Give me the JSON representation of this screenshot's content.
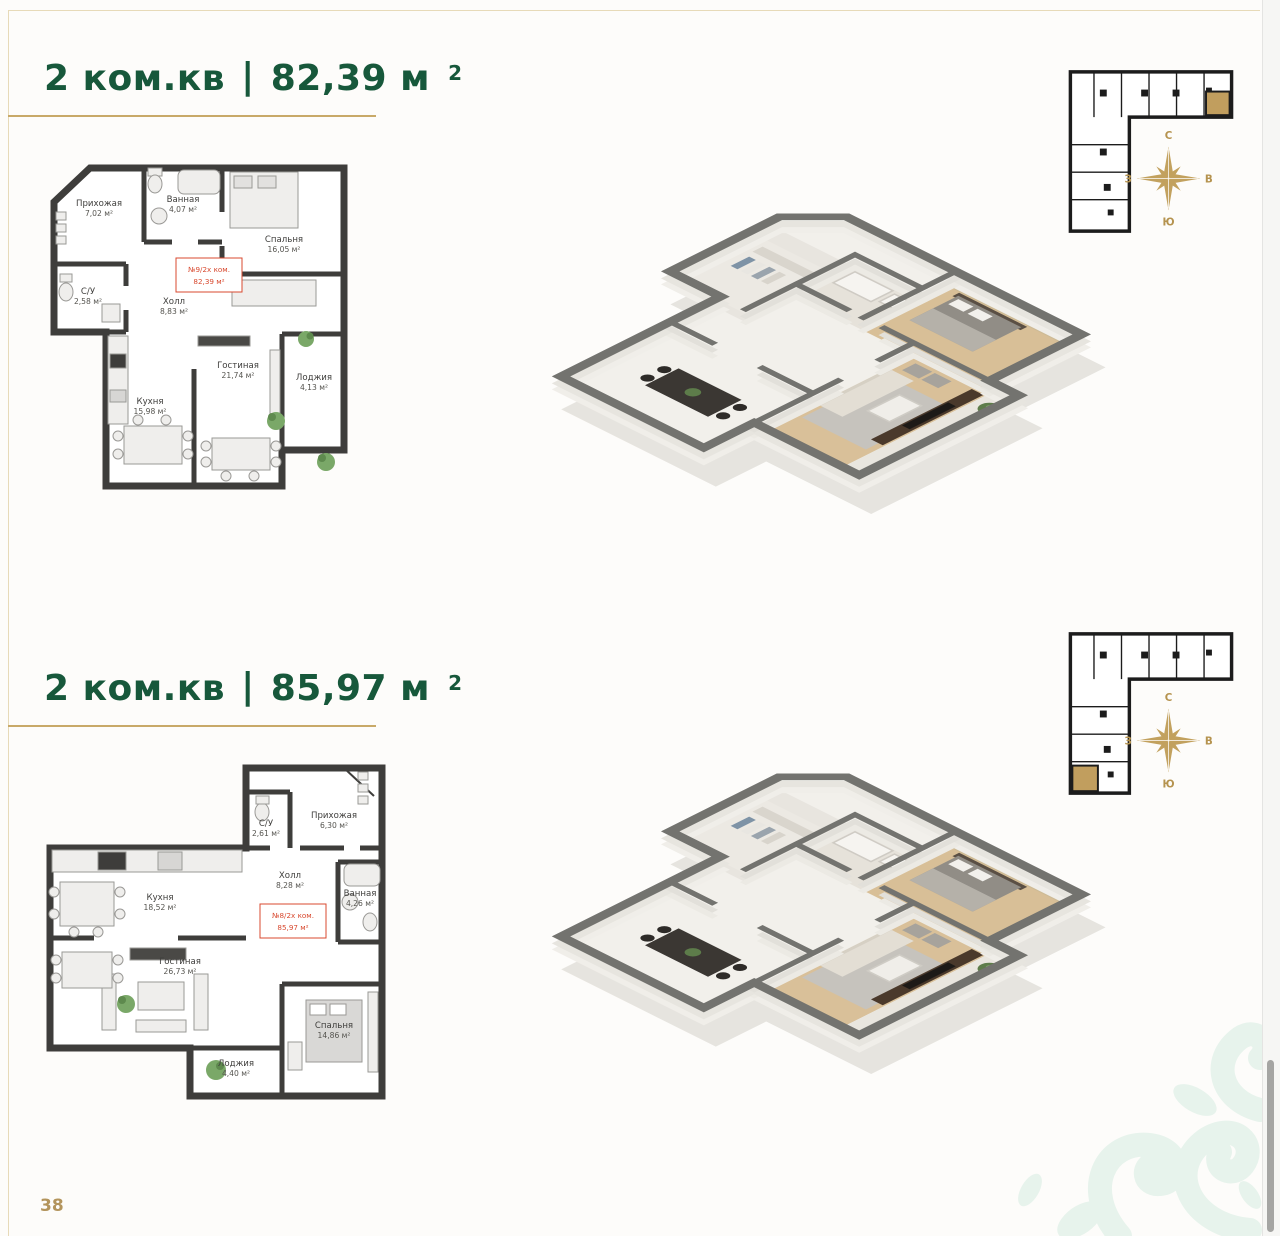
{
  "page": {
    "number": "38"
  },
  "colors": {
    "title_green": "#17583b",
    "gold": "#c8a968",
    "compass_gold": "#b5934f",
    "unit_red": "#d8492f",
    "wall_dark": "#3e3d3b",
    "keyplan_highlight": "#c19e5e",
    "ornament_mint": "#e7f3ec"
  },
  "compass": {
    "n": "С",
    "s": "Ю",
    "w": "З",
    "e": "В"
  },
  "sections": [
    {
      "title_prefix": "2 ком.кв",
      "separator": "|",
      "area_value": "82,39 м",
      "area_sup": "2",
      "unit_label_line1": "№9/2х ком.",
      "unit_label_line2": "82,39 м²",
      "rooms": [
        {
          "name": "Прихожая",
          "area": "7,02 м²"
        },
        {
          "name": "Ванная",
          "area": "4,07 м²"
        },
        {
          "name": "Спальня",
          "area": "16,05 м²"
        },
        {
          "name": "С/У",
          "area": "2,58 м²"
        },
        {
          "name": "Холл",
          "area": "8,83 м²"
        },
        {
          "name": "Лоджия",
          "area": "4,13 м²"
        },
        {
          "name": "Кухня",
          "area": "15,98 м²"
        },
        {
          "name": "Гостиная",
          "area": "21,74 м²"
        }
      ]
    },
    {
      "title_prefix": "2 ком.кв",
      "separator": "|",
      "area_value": "85,97 м",
      "area_sup": "2",
      "unit_label_line1": "№8/2х ком.",
      "unit_label_line2": "85,97 м²",
      "rooms": [
        {
          "name": "С/У",
          "area": "2,61 м²"
        },
        {
          "name": "Прихожая",
          "area": "6,30 м²"
        },
        {
          "name": "Холл",
          "area": "8,28 м²"
        },
        {
          "name": "Ванная",
          "area": "4,26 м²"
        },
        {
          "name": "Кухня",
          "area": "18,52 м²"
        },
        {
          "name": "Гостиная",
          "area": "26,73 м²"
        },
        {
          "name": "Спальня",
          "area": "14,86 м²"
        },
        {
          "name": "Лоджия",
          "area": "4,40 м²"
        }
      ]
    }
  ]
}
